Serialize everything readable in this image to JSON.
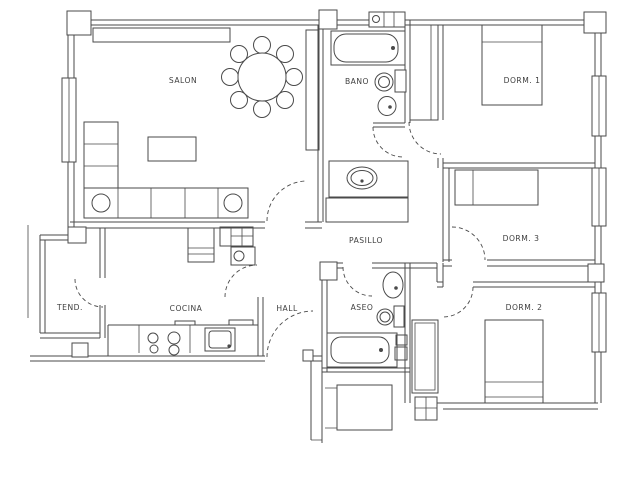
{
  "floor_plan": {
    "background": "#ffffff",
    "line_color": "#4a4a4a",
    "label_color": "#3e3e3e",
    "rooms": [
      {
        "id": "salon",
        "label": "SALON"
      },
      {
        "id": "bano",
        "label": "BANO"
      },
      {
        "id": "dorm-1",
        "label": "DORM. 1"
      },
      {
        "id": "dorm-3",
        "label": "DORM. 3"
      },
      {
        "id": "pasillo",
        "label": "PASILLO"
      },
      {
        "id": "dorm-2",
        "label": "DORM. 2"
      },
      {
        "id": "tendedero",
        "label": "TEND."
      },
      {
        "id": "cocina",
        "label": "COCINA"
      },
      {
        "id": "hall",
        "label": "HALL"
      },
      {
        "id": "aseo",
        "label": "ASEO"
      }
    ]
  }
}
